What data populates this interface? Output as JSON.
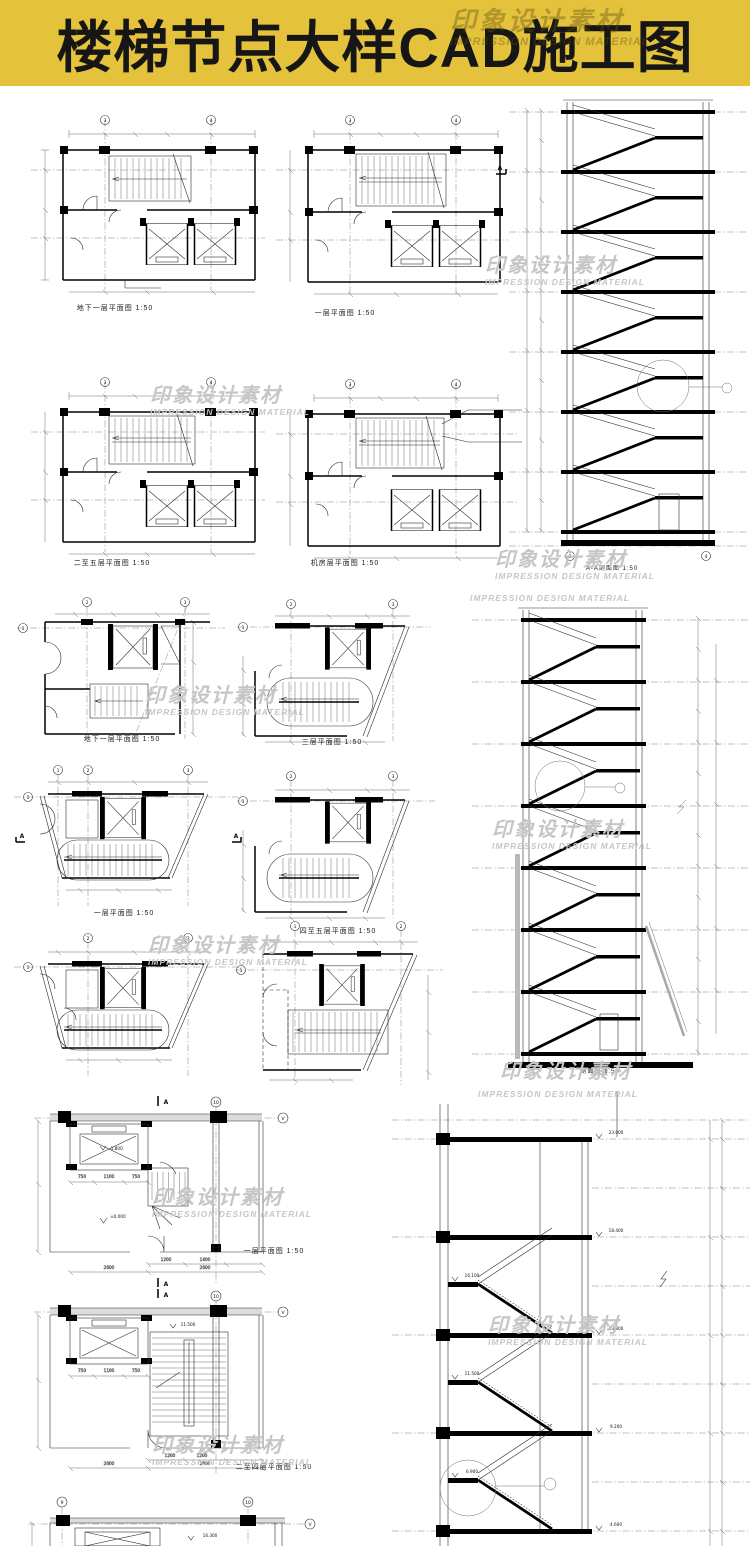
{
  "banner": {
    "title": "楼梯节点大样CAD施工图"
  },
  "watermark": {
    "cn": "印象设计素材",
    "en": "IMPRESSION DESIGN MATERIAL"
  },
  "captions": {
    "plan_a1": "地下一层平面图  1:50",
    "plan_a2": "一层平面图  1:50",
    "section_s1": "A-A剖面图  1:50",
    "plan_b1": "二至五层平面图  1:50",
    "plan_b2": "机房层平面图  1:50",
    "plan_c1": "地下一层平面图  1:50",
    "plan_c2": "三层平面图  1:50",
    "plan_d1": "一层平面图  1:50",
    "plan_d2": "四至五层平面图  1:50",
    "section_s2": "剖面图  1:50",
    "plan_f1": "一层平面图   1:50",
    "plan_f2": "二至四层平面图   1:50"
  },
  "bub": {
    "n1": "1",
    "n2": "2",
    "n3": "3",
    "n4": "4",
    "n9": "9",
    "n10": "10",
    "v": "V",
    "a": "A"
  },
  "dims": {
    "d750": "750",
    "d1100": "1100",
    "d1200": "1200",
    "d1400": "1400",
    "d2600": "2600"
  },
  "elev": {
    "zero": "±0.000",
    "pit": "-1.800",
    "mid": "11.500",
    "g": "16.300"
  },
  "s3": {
    "levels_right": [
      "23.000",
      "18.400",
      "13.800",
      "9.200",
      "4.600"
    ],
    "levels_left": [
      "16.100",
      "11.500",
      "6.900"
    ]
  }
}
